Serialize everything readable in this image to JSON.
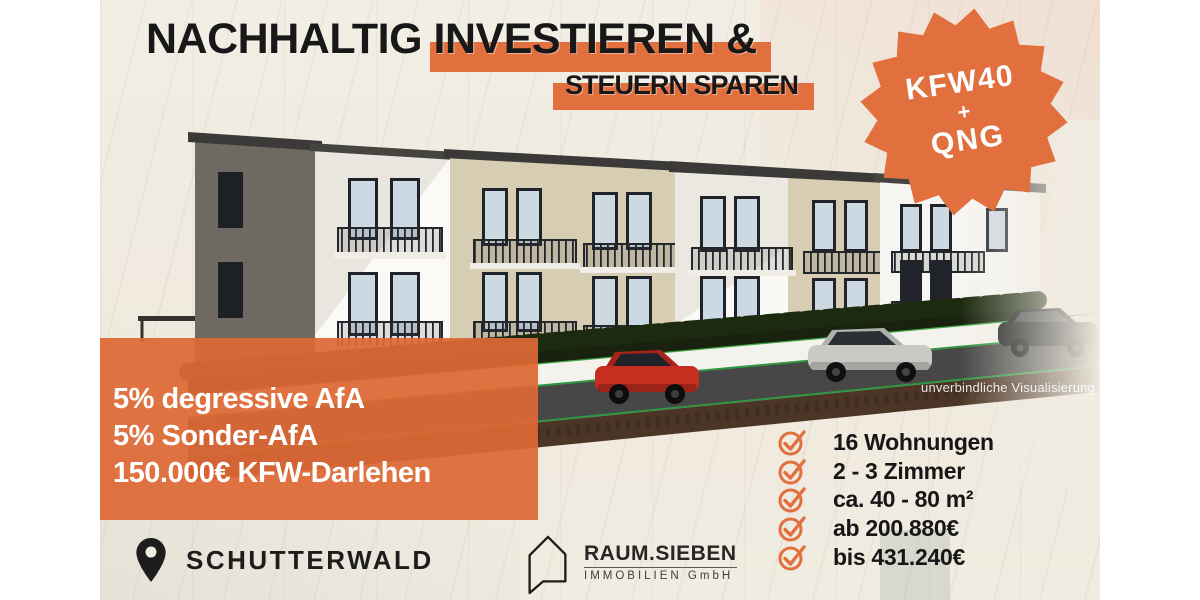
{
  "header": {
    "title_part1": "NACHHALTIG ",
    "title_part2": "INVESTIEREN &",
    "subtitle": "STEUERN SPAREN"
  },
  "badge": {
    "line1": "KFW40",
    "line2": "+",
    "line3": "QNG"
  },
  "offer_box": {
    "line1": "5% degressive AfA",
    "line2": "5% Sonder-AfA",
    "line3": "150.000€ KFW-Darlehen"
  },
  "features": {
    "items": [
      "16 Wohnungen",
      "2 - 3 Zimmer",
      "ca. 40 - 80 m²",
      "ab 200.880€",
      "bis 431.240€"
    ]
  },
  "location": {
    "name": "SCHUTTERWALD"
  },
  "logo": {
    "name": "RAUM.SIEBEN",
    "subtitle": "IMMOBILIEN GmbH"
  },
  "visualization": {
    "disclaimer": "unverbindliche Visualisierung"
  },
  "colors": {
    "accent": "#E2703F",
    "offer_box": "#DE6835",
    "headline_text": "#181818",
    "background": "#F0ECE2",
    "hedge_green_line": "#3AA33F",
    "road": "#474747",
    "soil_strip": "#4B3526"
  }
}
